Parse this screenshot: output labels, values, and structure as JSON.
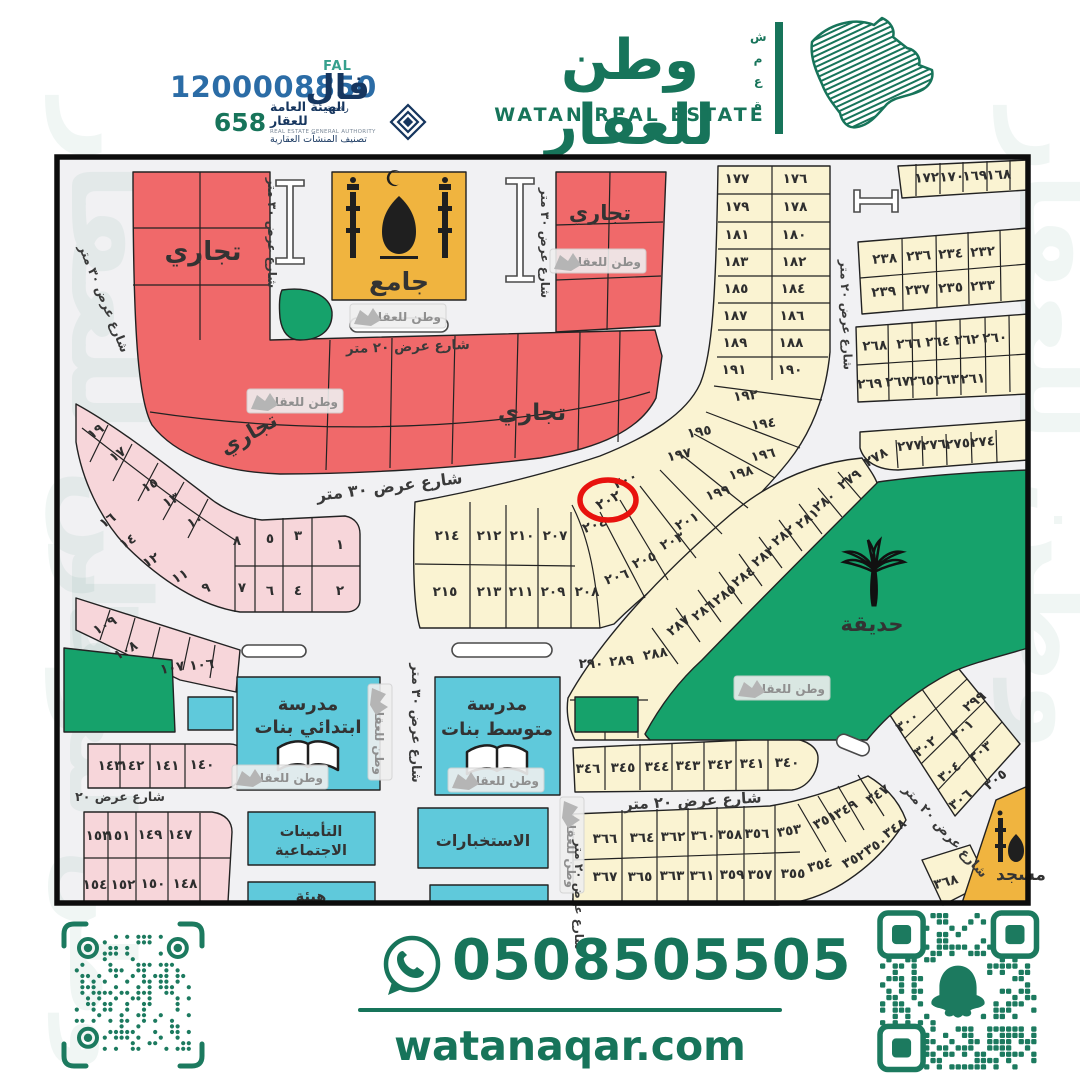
{
  "header": {
    "unified_number": "1200008850",
    "license_number": "658",
    "fal": {
      "latin": "FAL",
      "arabic": "فال",
      "sub": "رخصة"
    },
    "rega": {
      "line1": "الهيئة العامة للعقار",
      "line2": "REAL ESTATE GENERAL AUTHORITY",
      "line3": "تصنيف المنشآت العقارية"
    },
    "brand": {
      "name_ar": "وطن للعقار",
      "name_en": "WATAN REAL ESTATE",
      "vertical_word": "شمعة"
    }
  },
  "footer": {
    "whatsapp_number": "0508505505",
    "website": "watanaqar.com"
  },
  "colors": {
    "brand_green": "#17745a",
    "park_green": "#16a26b",
    "commercial_red": "#f0696a",
    "plot_cream": "#faf3d2",
    "plot_pink": "#f7d6da",
    "civic_cyan": "#5fc9db",
    "mosque_gold": "#f0b43f",
    "highlight_red": "#e8120e",
    "phone_blue": "#2b6ca6",
    "navy": "#16365f"
  },
  "map": {
    "watermark_text": "وطن للعقار",
    "highlight": {
      "plot_number": "٢٠٢",
      "cx": 608,
      "cy": 500
    },
    "areas": [
      {
        "t": "تجاري",
        "x": 203,
        "y": 260,
        "s": 26
      },
      {
        "t": "تجاري",
        "x": 600,
        "y": 220,
        "s": 21
      },
      {
        "t": "تجاري",
        "x": 252,
        "y": 440,
        "s": 21,
        "r": -30
      },
      {
        "t": "تجاري",
        "x": 532,
        "y": 420,
        "s": 23
      },
      {
        "t": "جامع",
        "x": 399,
        "y": 290,
        "s": 25
      },
      {
        "t": "حديقة",
        "x": 872,
        "y": 631,
        "s": 21
      },
      {
        "t": "مسجد",
        "x": 1021,
        "y": 880,
        "s": 17
      },
      {
        "t": "مدرسة",
        "x": 308,
        "y": 710,
        "s": 18
      },
      {
        "t": "ابتدائي بنات",
        "x": 308,
        "y": 733,
        "s": 18
      },
      {
        "t": "مدرسة",
        "x": 497,
        "y": 710,
        "s": 18
      },
      {
        "t": "متوسط بنات",
        "x": 497,
        "y": 735,
        "s": 18
      },
      {
        "t": "الاستخبارات",
        "x": 483,
        "y": 846,
        "s": 16
      },
      {
        "t": "التأمينات",
        "x": 311,
        "y": 836,
        "s": 14.5
      },
      {
        "t": "الاجتماعية",
        "x": 311,
        "y": 855,
        "s": 14.5
      },
      {
        "t": "هيئة",
        "x": 311,
        "y": 901,
        "s": 14.5
      }
    ],
    "streets": [
      {
        "t": "شارع عرض ٣٠ متر",
        "x": 390,
        "y": 492,
        "r": -7,
        "s": 16
      },
      {
        "t": "شارع عرض ٢٠ متر",
        "x": 408,
        "y": 351,
        "r": -2,
        "s": 13.5
      },
      {
        "t": "شارع عرض ٢٠ متر",
        "x": 693,
        "y": 806,
        "r": -3,
        "s": 15
      },
      {
        "t": "شارع عرض ٢٠",
        "x": 120,
        "y": 801,
        "s": 12.5
      },
      {
        "t": "شارع عرض ٣٠ متر",
        "x": 100,
        "y": 300,
        "r": 68,
        "s": 12.5
      },
      {
        "t": "شارع عرض ٣٠ متر",
        "x": 268,
        "y": 233,
        "r": 90,
        "s": 12
      },
      {
        "t": "شارع عرض ٣٠ متر",
        "x": 541,
        "y": 243,
        "r": 90,
        "s": 12
      },
      {
        "t": "شارع عرض ٢٠ متر",
        "x": 842,
        "y": 315,
        "r": 88,
        "s": 12
      },
      {
        "t": "شارع عرض ٣٠ متر",
        "x": 412,
        "y": 723,
        "r": 90,
        "s": 13
      },
      {
        "t": "شارع عرض ٢٠ متر",
        "x": 942,
        "y": 834,
        "r": 48,
        "s": 13
      },
      {
        "t": "شارع عرض ٢٠ متر",
        "x": 575,
        "y": 895,
        "r": 90,
        "s": 12
      }
    ],
    "plots": [
      {
        "t": "١٧٧",
        "x": 737,
        "y": 183
      },
      {
        "t": "١٧٦",
        "x": 795,
        "y": 183
      },
      {
        "t": "١٧٩",
        "x": 737,
        "y": 211
      },
      {
        "t": "١٧٨",
        "x": 795,
        "y": 211
      },
      {
        "t": "١٨١",
        "x": 737,
        "y": 239
      },
      {
        "t": "١٨٠",
        "x": 794,
        "y": 239
      },
      {
        "t": "١٨٣",
        "x": 736,
        "y": 266
      },
      {
        "t": "١٨٢",
        "x": 794,
        "y": 266
      },
      {
        "t": "١٨٥",
        "x": 736,
        "y": 293
      },
      {
        "t": "١٨٤",
        "x": 793,
        "y": 293
      },
      {
        "t": "١٨٧",
        "x": 735,
        "y": 320
      },
      {
        "t": "١٨٦",
        "x": 792,
        "y": 320
      },
      {
        "t": "١٨٩",
        "x": 735,
        "y": 347
      },
      {
        "t": "١٨٨",
        "x": 791,
        "y": 347
      },
      {
        "t": "١٩١",
        "x": 734,
        "y": 374
      },
      {
        "t": "١٩٠",
        "x": 790,
        "y": 374
      },
      {
        "t": "١٩٢",
        "x": 746,
        "y": 400,
        "r": -6
      },
      {
        "t": "١٩٤",
        "x": 764,
        "y": 428,
        "r": -8
      },
      {
        "t": "١٩٥",
        "x": 700,
        "y": 436,
        "r": -10
      },
      {
        "t": "١٩٧",
        "x": 680,
        "y": 459,
        "r": -12
      },
      {
        "t": "١٩٦",
        "x": 764,
        "y": 459,
        "r": -12
      },
      {
        "t": "١٩٨",
        "x": 742,
        "y": 477,
        "r": -15
      },
      {
        "t": "١٩٩",
        "x": 719,
        "y": 497,
        "r": -18
      },
      {
        "t": "٢٠٠",
        "x": 627,
        "y": 484,
        "r": -24
      },
      {
        "t": "٢٠٤",
        "x": 596,
        "y": 529,
        "r": -20
      },
      {
        "t": "٢٠١",
        "x": 689,
        "y": 525,
        "r": -28
      },
      {
        "t": "٢٠٣",
        "x": 674,
        "y": 545,
        "r": -26
      },
      {
        "t": "٢٠٥",
        "x": 646,
        "y": 564,
        "r": -24
      },
      {
        "t": "٢٠٦",
        "x": 618,
        "y": 581,
        "r": -18
      },
      {
        "t": "٢٠٧",
        "x": 555,
        "y": 540
      },
      {
        "t": "٢١٠",
        "x": 522,
        "y": 540
      },
      {
        "t": "٢١٢",
        "x": 489,
        "y": 540
      },
      {
        "t": "٢١٤",
        "x": 447,
        "y": 540
      },
      {
        "t": "٢١٥",
        "x": 445,
        "y": 596
      },
      {
        "t": "٢١٣",
        "x": 489,
        "y": 596
      },
      {
        "t": "٢١١",
        "x": 521,
        "y": 596
      },
      {
        "t": "٢٠٩",
        "x": 553,
        "y": 596
      },
      {
        "t": "٢٠٨",
        "x": 587,
        "y": 596
      },
      {
        "t": "١٧٢",
        "x": 927,
        "y": 182,
        "r": -3
      },
      {
        "t": "١٧٠",
        "x": 952,
        "y": 181,
        "r": -3
      },
      {
        "t": "١٦٩",
        "x": 975,
        "y": 180,
        "r": -3
      },
      {
        "t": "١٦٨",
        "x": 999,
        "y": 179,
        "r": -3
      },
      {
        "t": "٢٣٨",
        "x": 885,
        "y": 263,
        "r": -4
      },
      {
        "t": "٢٣٦",
        "x": 919,
        "y": 260,
        "r": -4
      },
      {
        "t": "٢٣٤",
        "x": 951,
        "y": 258,
        "r": -4
      },
      {
        "t": "٢٣٢",
        "x": 983,
        "y": 256,
        "r": -4
      },
      {
        "t": "٢٣٩",
        "x": 884,
        "y": 296,
        "r": -4
      },
      {
        "t": "٢٣٧",
        "x": 918,
        "y": 294,
        "r": -4
      },
      {
        "t": "٢٣٥",
        "x": 951,
        "y": 292,
        "r": -4
      },
      {
        "t": "٢٣٣",
        "x": 983,
        "y": 290,
        "r": -4
      },
      {
        "t": "٢٦٨",
        "x": 875,
        "y": 350,
        "r": -3
      },
      {
        "t": "٢٦٦",
        "x": 909,
        "y": 348,
        "r": -3
      },
      {
        "t": "٢٦٤",
        "x": 938,
        "y": 346,
        "r": -3
      },
      {
        "t": "٢٦٢",
        "x": 967,
        "y": 344,
        "r": -3
      },
      {
        "t": "٢٦٠",
        "x": 995,
        "y": 342,
        "r": -3
      },
      {
        "t": "٢٦٩",
        "x": 870,
        "y": 388,
        "r": -3
      },
      {
        "t": "٢٦٧",
        "x": 898,
        "y": 386,
        "r": -3
      },
      {
        "t": "٢٦٥",
        "x": 922,
        "y": 385,
        "r": -3
      },
      {
        "t": "٢٦٣",
        "x": 947,
        "y": 384,
        "r": -3
      },
      {
        "t": "٢٦١",
        "x": 973,
        "y": 383,
        "r": -3
      },
      {
        "t": "٢٧٨",
        "x": 878,
        "y": 461,
        "r": -30
      },
      {
        "t": "٢٧٧",
        "x": 910,
        "y": 450,
        "r": -5
      },
      {
        "t": "٢٧٦",
        "x": 934,
        "y": 449,
        "r": -5
      },
      {
        "t": "٢٧٥",
        "x": 958,
        "y": 448,
        "r": -5
      },
      {
        "t": "٢٧٤",
        "x": 983,
        "y": 446,
        "r": -5
      },
      {
        "t": "٢٧٩",
        "x": 852,
        "y": 483,
        "r": -36
      },
      {
        "t": "٢٨٠",
        "x": 827,
        "y": 505,
        "r": -38
      },
      {
        "t": "٢٨١",
        "x": 810,
        "y": 522,
        "r": -38
      },
      {
        "t": "٢٨٢",
        "x": 786,
        "y": 539,
        "r": -38
      },
      {
        "t": "٢٨٣",
        "x": 766,
        "y": 560,
        "r": -38
      },
      {
        "t": "٢٨٤",
        "x": 746,
        "y": 580,
        "r": -38
      },
      {
        "t": "٢٨٥",
        "x": 727,
        "y": 598,
        "r": -38
      },
      {
        "t": "٢٨٦",
        "x": 706,
        "y": 614,
        "r": -38
      },
      {
        "t": "٢٨٧",
        "x": 681,
        "y": 629,
        "r": -38
      },
      {
        "t": "٢٨٨",
        "x": 656,
        "y": 658,
        "r": -10
      },
      {
        "t": "٢٨٩",
        "x": 622,
        "y": 665,
        "r": -5
      },
      {
        "t": "٢٩٠",
        "x": 591,
        "y": 668
      },
      {
        "t": "٢٩٩",
        "x": 977,
        "y": 705,
        "r": -38
      },
      {
        "t": "٣٠٠",
        "x": 910,
        "y": 725,
        "r": -38
      },
      {
        "t": "٣٠١",
        "x": 965,
        "y": 733,
        "r": -38
      },
      {
        "t": "٣٠٢",
        "x": 928,
        "y": 750,
        "r": -38
      },
      {
        "t": "٣٠٣",
        "x": 983,
        "y": 755,
        "r": -38
      },
      {
        "t": "٣٠٤",
        "x": 952,
        "y": 775,
        "r": -38
      },
      {
        "t": "٣٠٥",
        "x": 998,
        "y": 783,
        "r": -38
      },
      {
        "t": "٣٠٦",
        "x": 963,
        "y": 803,
        "r": -38
      },
      {
        "t": "٣٤٦",
        "x": 588,
        "y": 773
      },
      {
        "t": "٣٤٥",
        "x": 623,
        "y": 772
      },
      {
        "t": "٣٤٤",
        "x": 657,
        "y": 771
      },
      {
        "t": "٣٤٣",
        "x": 688,
        "y": 770
      },
      {
        "t": "٣٤٢",
        "x": 720,
        "y": 769
      },
      {
        "t": "٣٤١",
        "x": 752,
        "y": 768
      },
      {
        "t": "٣٤٠",
        "x": 787,
        "y": 767
      },
      {
        "t": "٣٦٦",
        "x": 605,
        "y": 843
      },
      {
        "t": "٣٦٤",
        "x": 642,
        "y": 842
      },
      {
        "t": "٣٦٢",
        "x": 673,
        "y": 841
      },
      {
        "t": "٣٦٠",
        "x": 703,
        "y": 840
      },
      {
        "t": "٣٥٨",
        "x": 730,
        "y": 839
      },
      {
        "t": "٣٥٦",
        "x": 757,
        "y": 838
      },
      {
        "t": "٣٥٣",
        "x": 790,
        "y": 835,
        "r": -10
      },
      {
        "t": "٣٥١",
        "x": 827,
        "y": 824,
        "r": -28
      },
      {
        "t": "٣٤٩",
        "x": 848,
        "y": 813,
        "r": -32
      },
      {
        "t": "٣٤٧",
        "x": 880,
        "y": 798,
        "r": -34
      },
      {
        "t": "٣٤٨",
        "x": 897,
        "y": 832,
        "r": -34
      },
      {
        "t": "٣٥٠",
        "x": 878,
        "y": 849,
        "r": -32
      },
      {
        "t": "٣٥٢",
        "x": 856,
        "y": 863,
        "r": -28
      },
      {
        "t": "٣٥٤",
        "x": 821,
        "y": 869,
        "r": -15
      },
      {
        "t": "٣٦٧",
        "x": 605,
        "y": 881
      },
      {
        "t": "٣٦٥",
        "x": 640,
        "y": 881
      },
      {
        "t": "٣٦٣",
        "x": 672,
        "y": 880
      },
      {
        "t": "٣٦١",
        "x": 702,
        "y": 880
      },
      {
        "t": "٣٥٩",
        "x": 732,
        "y": 879
      },
      {
        "t": "٣٥٧",
        "x": 760,
        "y": 879
      },
      {
        "t": "٣٥٥",
        "x": 793,
        "y": 878
      },
      {
        "t": "٣٦٨",
        "x": 947,
        "y": 886,
        "r": -15
      },
      {
        "t": "١٩",
        "x": 98,
        "y": 435,
        "r": -35
      },
      {
        "t": "١٧",
        "x": 120,
        "y": 458,
        "r": -35
      },
      {
        "t": "١٥",
        "x": 152,
        "y": 489,
        "r": -30
      },
      {
        "t": "١٣",
        "x": 173,
        "y": 504,
        "r": -30
      },
      {
        "t": "١٠",
        "x": 197,
        "y": 525,
        "r": -25
      },
      {
        "t": "١٦",
        "x": 110,
        "y": 524,
        "r": -35
      },
      {
        "t": "١٤",
        "x": 130,
        "y": 545,
        "r": -32
      },
      {
        "t": "١٢",
        "x": 153,
        "y": 564,
        "r": -30
      },
      {
        "t": "١١",
        "x": 182,
        "y": 580,
        "r": -28
      },
      {
        "t": "٩",
        "x": 207,
        "y": 592,
        "r": -15
      },
      {
        "t": "٨",
        "x": 237,
        "y": 545
      },
      {
        "t": "٥",
        "x": 270,
        "y": 543
      },
      {
        "t": "٣",
        "x": 298,
        "y": 540
      },
      {
        "t": "١",
        "x": 340,
        "y": 549
      },
      {
        "t": "٧",
        "x": 242,
        "y": 592
      },
      {
        "t": "٦",
        "x": 270,
        "y": 595
      },
      {
        "t": "٤",
        "x": 298,
        "y": 595
      },
      {
        "t": "٢",
        "x": 340,
        "y": 595
      },
      {
        "t": "١٠٩",
        "x": 107,
        "y": 629,
        "r": -30
      },
      {
        "t": "١٠٨",
        "x": 128,
        "y": 654,
        "r": -30
      },
      {
        "t": "١٠٧",
        "x": 173,
        "y": 672,
        "r": -10
      },
      {
        "t": "١٠٦",
        "x": 202,
        "y": 669,
        "r": -5
      },
      {
        "t": "١٤٣",
        "x": 110,
        "y": 770
      },
      {
        "t": "١٤٢",
        "x": 132,
        "y": 770
      },
      {
        "t": "١٤١",
        "x": 167,
        "y": 770
      },
      {
        "t": "١٤٠",
        "x": 202,
        "y": 769
      },
      {
        "t": "١٥٣",
        "x": 98,
        "y": 840
      },
      {
        "t": "١٥١",
        "x": 118,
        "y": 840
      },
      {
        "t": "١٤٩",
        "x": 150,
        "y": 839
      },
      {
        "t": "١٤٧",
        "x": 180,
        "y": 839
      },
      {
        "t": "١٥٤",
        "x": 95,
        "y": 889
      },
      {
        "t": "١٥٢",
        "x": 123,
        "y": 889
      },
      {
        "t": "١٥٠",
        "x": 153,
        "y": 888
      },
      {
        "t": "١٤٨",
        "x": 185,
        "y": 888
      }
    ],
    "watermarks": [
      {
        "x": 398,
        "y": 316
      },
      {
        "x": 295,
        "y": 401
      },
      {
        "x": 598,
        "y": 261
      },
      {
        "x": 782,
        "y": 688
      },
      {
        "x": 280,
        "y": 777
      },
      {
        "x": 496,
        "y": 780
      },
      {
        "x": 380,
        "y": 732,
        "r": 90
      },
      {
        "x": 572,
        "y": 845,
        "r": 90
      }
    ],
    "big_watermarks": [
      {
        "x": 72,
        "y": 420,
        "r": 90,
        "s": 110
      },
      {
        "x": 1020,
        "y": 430,
        "r": 90,
        "s": 110
      },
      {
        "x": 70,
        "y": 810,
        "r": 90,
        "s": 90
      }
    ]
  }
}
